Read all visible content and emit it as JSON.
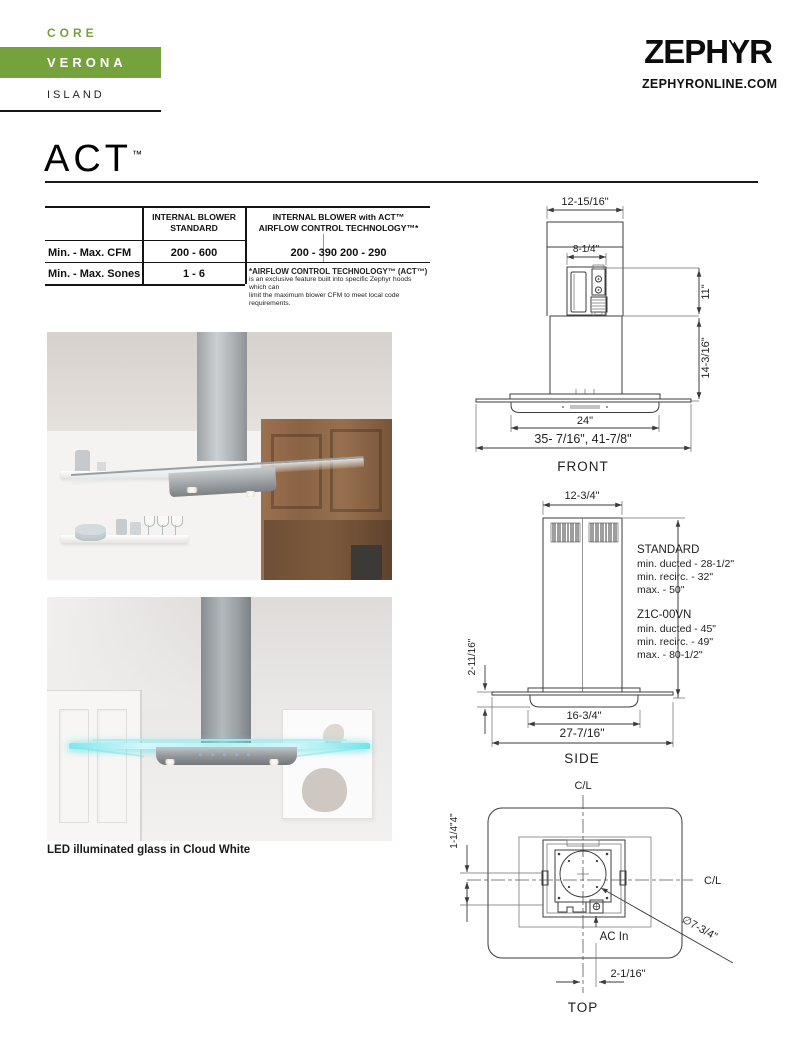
{
  "header": {
    "series": "CORE",
    "model": "VERONA",
    "type": "ISLAND"
  },
  "brand": {
    "logo": "ZEPHYR",
    "website": "ZEPHYRONLINE.COM"
  },
  "page_title": {
    "text": "ACT",
    "tm": "™"
  },
  "colors": {
    "accent_green": "#76a23e",
    "led_cyan": "#7fe6ec"
  },
  "spec_table": {
    "header_standard_line1": "INTERNAL BLOWER",
    "header_standard_line2": "STANDARD",
    "header_act_line1": "INTERNAL BLOWER with ACT™",
    "header_act_line2": "AIRFLOW CONTROL TECHNOLOGY™*",
    "row_cfm_label": "Min. - Max. CFM",
    "row_cfm_standard": "200 - 600",
    "row_cfm_act": "200 - 390 200 - 290",
    "row_sones_label": "Min. - Max. Sones",
    "row_sones_standard": "1 - 6",
    "footnote_title": "*AIRFLOW CONTROL TECHNOLOGY™ (ACT™)",
    "footnote_line1": "is an exclusive feature built into specific Zephyr hoods which can",
    "footnote_line2": "limit the maximum blower CFM to meet local code requirements."
  },
  "photos": {
    "caption": "LED illuminated glass in Cloud White"
  },
  "drawings": {
    "front": {
      "label": "FRONT",
      "chimney_width": "12-15/16\"",
      "blower_width": "8-1/4\"",
      "upper_height": "11\"",
      "lower_height": "14-3/16\"",
      "body_width": "24\"",
      "overall_width": "35- 7/16\", 41-7/8\""
    },
    "side": {
      "label": "SIDE",
      "chimney_depth": "12-3/4\"",
      "glass_height": "2-11/16\"",
      "body_depth": "16-3/4\"",
      "overall_depth": "27-7/16\"",
      "standard_title": "STANDARD",
      "standard_ducted": "min. ducted - 28-1/2\"",
      "standard_recirc": "min. recirc. - 32\"",
      "standard_max": "max. - 50\"",
      "alt_title": "Z1C-00VN",
      "alt_ducted": "min. ducted - 45\"",
      "alt_recirc": "min. recirc. - 49\"",
      "alt_max": "max. - 80-1/2\""
    },
    "top": {
      "label": "TOP",
      "centerline_vertical": "C/L",
      "centerline_horizontal": "C/L",
      "left_offsets": "1-1/4\"4\"",
      "ac_in": "AC In",
      "duct_diameter": "∅7-3/4\"",
      "ac_offset": "2-1/16\""
    }
  }
}
